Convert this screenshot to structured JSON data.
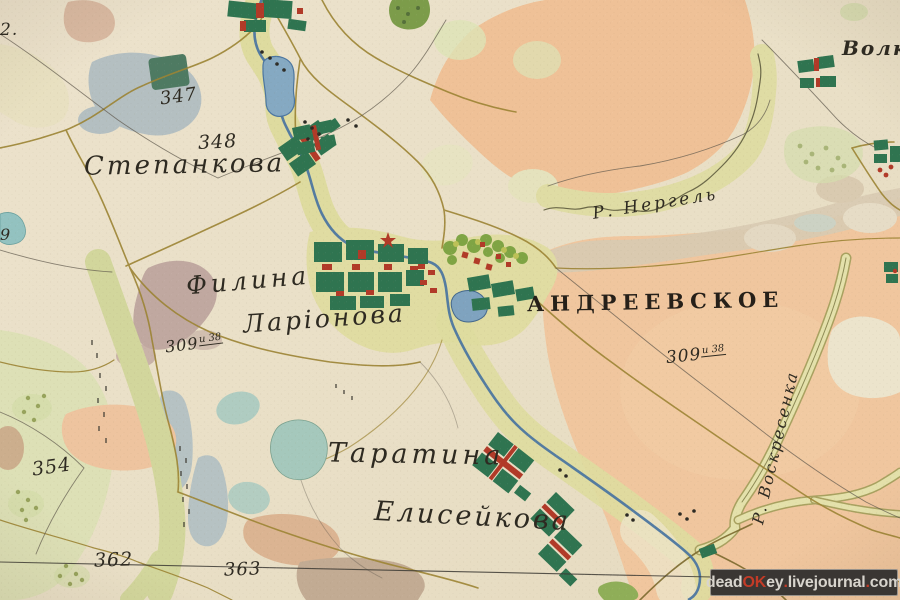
{
  "map_type": "historical-survey-map-scan",
  "settlements": {
    "stepankova": "Степанкова",
    "filina": "Филина",
    "larionova": "Ларіонова",
    "andreevskoye": "АНДРЕЕВСКОЕ",
    "taratina": "Таратина",
    "eliseykova": "Елисейкова",
    "volk_partial": "Волк"
  },
  "rivers": {
    "nergel": "Р. Нергель",
    "voskresenka": "Р. Воскресенка"
  },
  "survey_numbers": {
    "n347": "347",
    "n348": "348",
    "n354": "354",
    "n362": "362",
    "n363": "363",
    "n309_left": {
      "main": "309",
      "sup": "и 38"
    },
    "n309_right": {
      "main": "309",
      "sup": "и 38"
    },
    "edge_left_top": "2.",
    "edge_left_mid": "9"
  },
  "watermark": {
    "text": "deadOKey.livejournal.com",
    "segments": [
      {
        "text": "dead"
      },
      {
        "text": "OK"
      },
      {
        "text": "ey"
      },
      {
        "text": "."
      },
      {
        "text": "livejournal"
      },
      {
        "text": "."
      },
      {
        "text": "com"
      }
    ]
  },
  "palette": {
    "paper": "#e9dfc7",
    "field_peach": "#efc49c",
    "meadow_olive": "#dedb9f",
    "forest_gray_blue": "#b4bfc1",
    "village_green": "#2f7450",
    "village_red": "#b13a28",
    "river_blue": "#4c76a0",
    "road_gold": "#9c8434",
    "mauve": "#c0a8a0",
    "tan_band": "#d8cab2",
    "watermark_bg": "#3a3633",
    "watermark_red": "#c33b27"
  }
}
